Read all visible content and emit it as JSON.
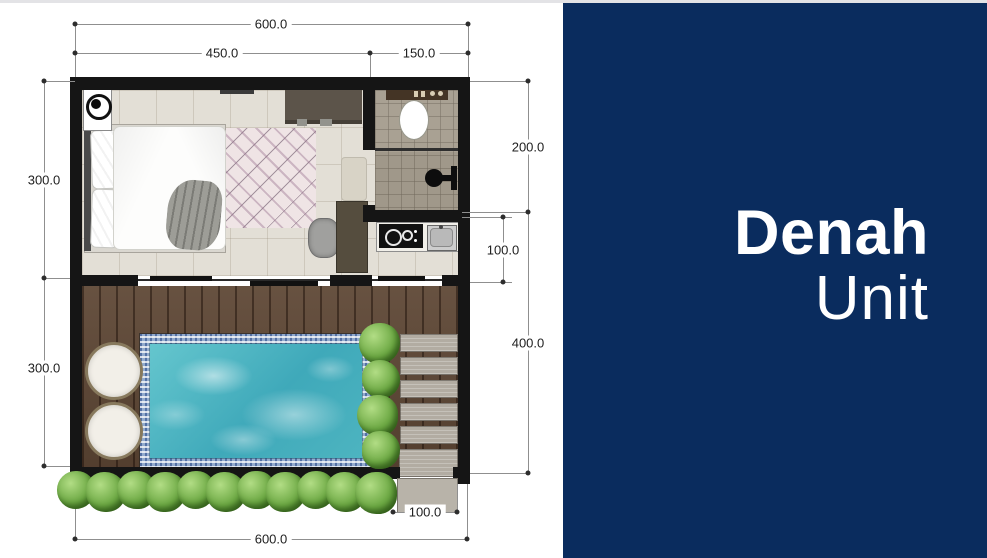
{
  "panel": {
    "title_line1": "Denah",
    "title_line2": "Unit",
    "background": "#0a2c5e",
    "text_color": "#ffffff"
  },
  "floorplan": {
    "dimensions": {
      "top_total": "600.0",
      "top_left_span": "450.0",
      "top_right_span": "150.0",
      "left_upper": "300.0",
      "left_lower": "300.0",
      "right_bathroom": "200.0",
      "right_kitchen": "100.0",
      "right_pool": "400.0",
      "bottom_steps": "100.0",
      "bottom_total": "600.0"
    },
    "colors": {
      "wall": "#151515",
      "pool_water": "#4fb6c2",
      "pool_tile": "#93abcd",
      "deck_wood": "#5e4735",
      "bedroom_floor": "#e3dfd6",
      "bathroom_tile": "#a9a193",
      "greenery": "#6da944",
      "stone_step": "#b2aca2",
      "dimension_line": "#8f8f8f"
    }
  }
}
